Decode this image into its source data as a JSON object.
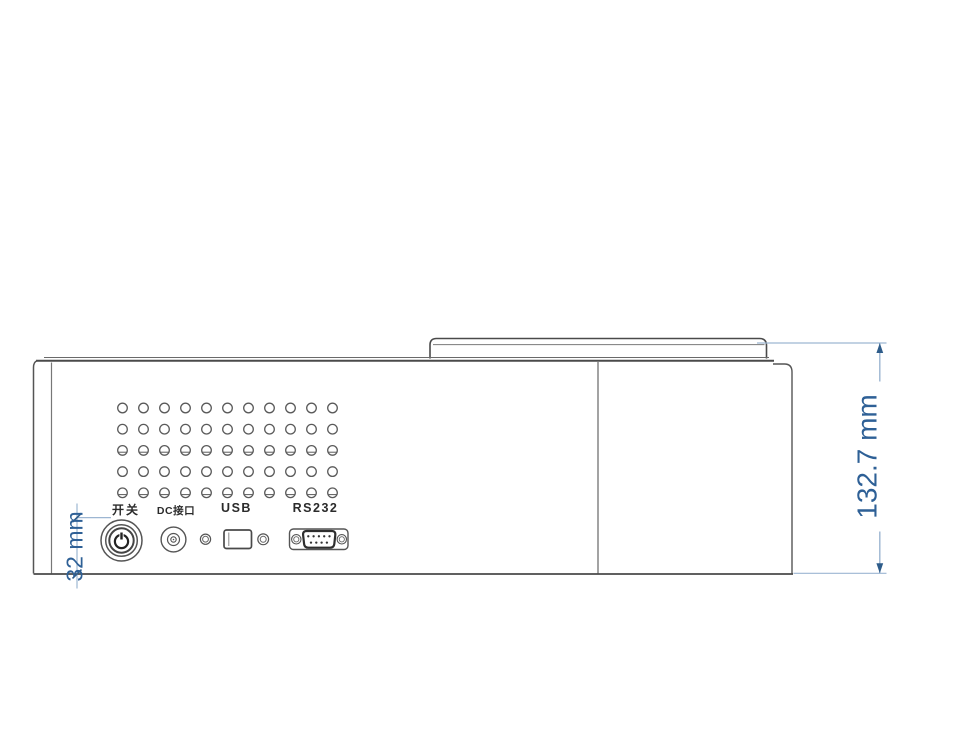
{
  "title": "device-side-panel-dimension-drawing",
  "ports": {
    "power_label": "开关",
    "dc_label": "DC接口",
    "usb_label": "USB",
    "rs232_label": "RS232"
  },
  "dimensions": {
    "total_height": "132.7 mm",
    "port_strip_height": "32 mm"
  },
  "colors": {
    "dimension_text_blue": "#2e6096",
    "dimension_line_blue": "#9db6d2",
    "dimension_tick_blue": "#2e5c8a",
    "outline_gray": "#4a4a4a",
    "label_ink": "#2b2b2b"
  },
  "vent_grid": {
    "rows": 5,
    "cols": 11,
    "x0": 122.5,
    "y0": 408,
    "dx": 21,
    "dy": 21.2,
    "r": 4.8,
    "chord_rows": [
      2,
      4
    ]
  },
  "rs232_pins": {
    "top_row": 5,
    "bottom_row": 4
  }
}
